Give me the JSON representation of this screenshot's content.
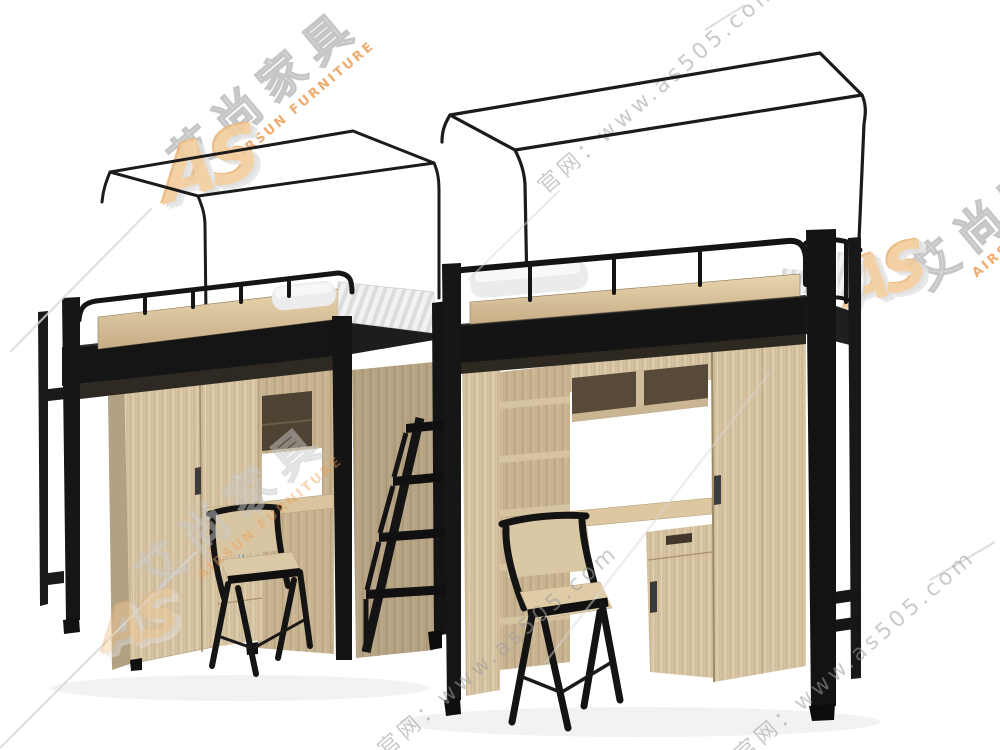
{
  "meta": {
    "type": "product-photo",
    "description": "Two black metal loft beds with wood wardrobe, bookshelf and desk underneath, chairs in front, mosquito-net canopy frames on top, white background"
  },
  "watermark": {
    "brand_cn": "艾尚家具",
    "brand_en": "AIRSUN FURNITURE",
    "logo_monogram": "AS",
    "url_text": "www.as505.com",
    "official_site_text": "官网：www.as505.com",
    "colors": {
      "brand_orange": "#ee9d55",
      "logo_tan": "#f2cd9c",
      "gray_text": "#9f9f9f",
      "gray_line": "#d8d8d8"
    }
  },
  "scene": {
    "background_color": "#ffffff",
    "colors": {
      "metal_black": "#161616",
      "wood_light": "#d7c4a4",
      "wood_shadow": "#b3a184",
      "fascia_light": "#e6d2ad",
      "mattress_white": "#ececec",
      "cubby_interior": "#54462f"
    },
    "objects": [
      "loft-bed-unit-left",
      "loft-bed-unit-right",
      "mosquito-net-frame-left",
      "mosquito-net-frame-right",
      "ladder",
      "desk-chair-left",
      "desk-chair-right",
      "wardrobe",
      "bookshelf",
      "desk",
      "pillow",
      "mattress"
    ]
  }
}
